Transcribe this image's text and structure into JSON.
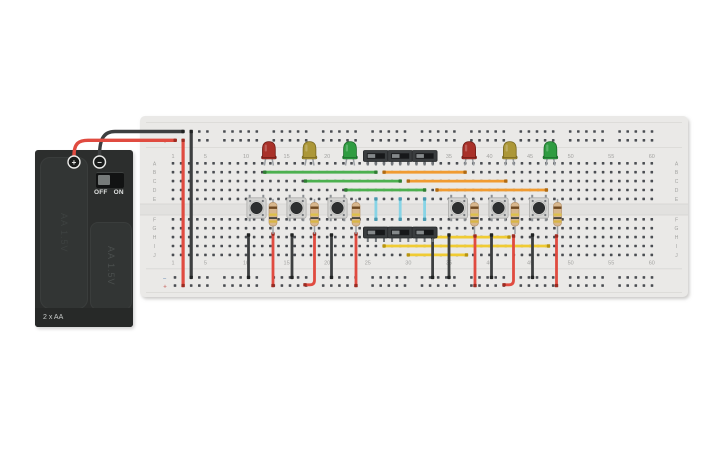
{
  "scene": {
    "width": 725,
    "height": 453,
    "background": "#ffffff"
  },
  "battery": {
    "pack_label": "2 x AA",
    "cell_label": "AA 1.5V",
    "terminals": {
      "positive": "+",
      "negative": "−"
    },
    "power_switch": {
      "state": "OFF",
      "label_off": "OFF",
      "label_on": "ON"
    }
  },
  "breadboard": {
    "row_letters": [
      "A",
      "B",
      "C",
      "D",
      "E",
      "F",
      "G",
      "H",
      "I",
      "J"
    ],
    "column_labels": [
      "1",
      "5",
      "10",
      "15",
      "20",
      "25",
      "30",
      "35",
      "40",
      "45",
      "50",
      "55",
      "60"
    ],
    "rail_plus": "+",
    "rail_minus": "−"
  },
  "palette": {
    "board": "#eae9e7",
    "channel": "#e2e1df",
    "channel_line": "#d3d2d0",
    "divider_line": "#d8d7d5",
    "hole": "#4a4d52",
    "label": "#a3a3a1",
    "marker_plus": "#cf7f79",
    "marker_minus": "#8fa6c2",
    "wire_colors": {
      "red": "#e04b40",
      "black": "#3d3f40",
      "green": "#4cb04f",
      "orange": "#f09b31",
      "yellow": "#f0cb33",
      "cyan": "#87d4e6"
    },
    "wire_caps": {
      "red": "#9c2b21",
      "black": "#202222",
      "green": "#2e7d32",
      "orange": "#b06a12",
      "yellow": "#b8940f",
      "cyan": "#4a98ae"
    },
    "led_body": {
      "red": "#a93129",
      "yellow": "#ac9738",
      "green": "#2f9c41"
    },
    "led_stroke": {
      "red": "#6f1c16",
      "yellow": "#77671f",
      "green": "#1d6b2b"
    },
    "resistor_body": "#d8b78d",
    "resistor_stroke": "#b8946a",
    "resistor_bands": [
      "#6f4a22",
      "#ddc04a",
      "#3c3c3a",
      "#d9b544"
    ],
    "lead": "#9ca0a4",
    "button_body": "#d3d3d1",
    "button_cap": "#2d2f30",
    "switch_body": "#3a3d3f",
    "switch_slot": "#17181a",
    "switch_knob": "#85898b",
    "pin": "#73777b"
  },
  "circuit": {
    "wires": [
      {
        "name": "battery-wire-negative",
        "color": "black",
        "path": "M99.5,156 C99.5,137 105,131.5 115,131.5 L183,131.5",
        "caps": [
          [
            183,
            131.5
          ]
        ],
        "w": 3.4
      },
      {
        "name": "battery-wire-positive",
        "color": "red",
        "path": "M74,156 C74,143 79,140.3 88,140.3 L175.2,140.3",
        "caps": [
          [
            175.2,
            140.3
          ]
        ],
        "w": 3.4
      },
      {
        "name": "rail-jumper-red",
        "color": "red",
        "x1": 183.1,
        "y1": 140.3,
        "x2": 183.1,
        "y2": 285.6,
        "w": 3.2
      },
      {
        "name": "rail-jumper-black",
        "color": "black",
        "x1": 191.2,
        "y1": 131.5,
        "x2": 191.2,
        "y2": 277.4,
        "w": 3.2
      },
      {
        "name": "wire-green-row-b",
        "color": "green",
        "x1": 264.8,
        "y1": 172.2,
        "x2": 375.9,
        "y2": 172.2
      },
      {
        "name": "wire-green-row-c",
        "color": "green",
        "x1": 305.4,
        "y1": 181.1,
        "x2": 400.2,
        "y2": 181.1
      },
      {
        "name": "wire-green-row-d",
        "color": "green",
        "x1": 345.9,
        "y1": 190,
        "x2": 424.6,
        "y2": 190
      },
      {
        "name": "wire-orange-row-b",
        "color": "orange",
        "x1": 384.1,
        "y1": 172.2,
        "x2": 465.1,
        "y2": 172.2
      },
      {
        "name": "wire-orange-row-c",
        "color": "orange",
        "x1": 408.3,
        "y1": 181.1,
        "x2": 505.8,
        "y2": 181.1
      },
      {
        "name": "wire-orange-row-d",
        "color": "orange",
        "x1": 437,
        "y1": 190,
        "x2": 546.4,
        "y2": 190
      },
      {
        "name": "wire-cyan-1",
        "color": "cyan",
        "x1": 375.9,
        "y1": 198.9,
        "x2": 375.9,
        "y2": 219.3
      },
      {
        "name": "wire-cyan-2",
        "color": "cyan",
        "x1": 400.2,
        "y1": 198.9,
        "x2": 400.2,
        "y2": 219.3
      },
      {
        "name": "wire-cyan-3",
        "color": "cyan",
        "x1": 424.6,
        "y1": 198.9,
        "x2": 424.6,
        "y2": 219.3
      },
      {
        "name": "wire-yellow-row-h",
        "color": "yellow",
        "x1": 433,
        "y1": 237.1,
        "x2": 509,
        "y2": 237.1
      },
      {
        "name": "wire-yellow-row-i",
        "color": "yellow",
        "x1": 384.1,
        "y1": 246,
        "x2": 548.5,
        "y2": 246
      },
      {
        "name": "wire-yellow-row-j",
        "color": "yellow",
        "x1": 408.3,
        "y1": 254.9,
        "x2": 466.5,
        "y2": 254.9
      },
      {
        "name": "wire-black-1",
        "color": "black",
        "x1": 248.5,
        "y1": 235,
        "x2": 248.5,
        "y2": 277.4
      },
      {
        "name": "wire-black-2",
        "color": "black",
        "x1": 292,
        "y1": 235,
        "x2": 292,
        "y2": 277.4
      },
      {
        "name": "wire-black-3",
        "color": "black",
        "x1": 331.5,
        "y1": 235,
        "x2": 331.5,
        "y2": 277.4
      },
      {
        "name": "wire-black-4",
        "color": "black",
        "x1": 432.6,
        "y1": 237.5,
        "x2": 432.6,
        "y2": 277.4
      },
      {
        "name": "wire-black-5",
        "color": "black",
        "x1": 449,
        "y1": 235,
        "x2": 449,
        "y2": 277.4
      },
      {
        "name": "wire-black-6",
        "color": "black",
        "x1": 491.5,
        "y1": 235,
        "x2": 491.5,
        "y2": 277.4
      },
      {
        "name": "wire-black-7",
        "color": "black",
        "x1": 532.5,
        "y1": 235,
        "x2": 532.5,
        "y2": 277.4
      },
      {
        "name": "wire-red-1",
        "color": "red",
        "x1": 273,
        "y1": 234,
        "x2": 273,
        "y2": 285.6
      },
      {
        "name": "wire-red-2",
        "color": "red",
        "path": "M314.5,234 L314.5,280.2 Q314.5,284.8 309.9,284.8 L305,284.8",
        "caps": [
          [
            314.5,
            234
          ],
          [
            305,
            284.8
          ]
        ]
      },
      {
        "name": "wire-red-3",
        "color": "red",
        "x1": 356,
        "y1": 234,
        "x2": 356,
        "y2": 285.6
      },
      {
        "name": "wire-red-4",
        "color": "red",
        "x1": 475,
        "y1": 236,
        "x2": 475,
        "y2": 285.6
      },
      {
        "name": "wire-red-5",
        "color": "red",
        "path": "M513.5,236 L513.5,280.2 Q513.5,284.8 508.9,284.8 L504,284.8",
        "caps": [
          [
            513.5,
            236
          ],
          [
            504,
            284.8
          ]
        ]
      },
      {
        "name": "wire-red-6",
        "color": "red",
        "x1": 556.5,
        "y1": 236,
        "x2": 556.5,
        "y2": 285.6
      }
    ],
    "leds": [
      {
        "name": "led-red-left",
        "color": "red",
        "x": 268.9
      },
      {
        "name": "led-yellow-left",
        "color": "yellow",
        "x": 309.5
      },
      {
        "name": "led-green-left",
        "color": "green",
        "x": 350
      },
      {
        "name": "led-red-right",
        "color": "red",
        "x": 469.2
      },
      {
        "name": "led-yellow-right",
        "color": "yellow",
        "x": 509.8
      },
      {
        "name": "led-green-right",
        "color": "green",
        "x": 550.4
      }
    ],
    "slide_switches": [
      {
        "name": "slide-switch-top-1",
        "x": 375.9,
        "pos": "top"
      },
      {
        "name": "slide-switch-top-2",
        "x": 400.2,
        "pos": "top"
      },
      {
        "name": "slide-switch-top-3",
        "x": 424.6,
        "pos": "top"
      },
      {
        "name": "slide-switch-bottom-1",
        "x": 375.9,
        "pos": "bottom"
      },
      {
        "name": "slide-switch-bottom-2",
        "x": 400.2,
        "pos": "bottom"
      },
      {
        "name": "slide-switch-bottom-3",
        "x": 424.6,
        "pos": "bottom"
      }
    ],
    "pushbuttons": [
      {
        "name": "pushbutton-1",
        "x": 256.5
      },
      {
        "name": "pushbutton-2",
        "x": 296.5
      },
      {
        "name": "pushbutton-3",
        "x": 337.5
      },
      {
        "name": "pushbutton-4",
        "x": 458
      },
      {
        "name": "pushbutton-5",
        "x": 498.5
      },
      {
        "name": "pushbutton-6",
        "x": 539
      }
    ],
    "resistors": [
      {
        "name": "resistor-1",
        "x": 273
      },
      {
        "name": "resistor-2",
        "x": 314.5
      },
      {
        "name": "resistor-3",
        "x": 356
      },
      {
        "name": "resistor-4",
        "x": 474.5
      },
      {
        "name": "resistor-5",
        "x": 515
      },
      {
        "name": "resistor-6",
        "x": 557.5
      }
    ]
  }
}
